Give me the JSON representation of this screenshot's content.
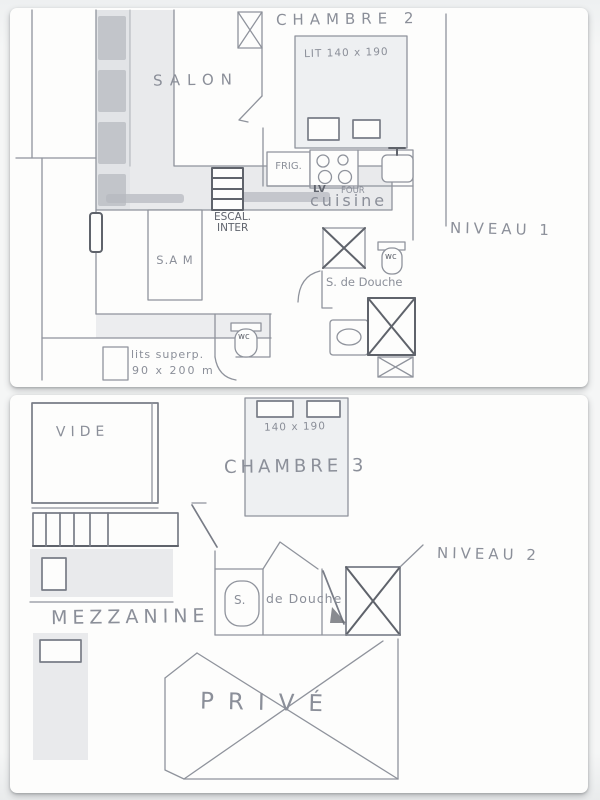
{
  "colors": {
    "background": "#f2f3f4",
    "paper": "#fdfdfc",
    "pencil": "#8f939c",
    "pencil_dark": "#5f636b",
    "wall_shade": "#e9eaec",
    "wall_block": "#b6b9bf"
  },
  "niveau1": {
    "title": "NIVEAU  1",
    "salon": "SALON",
    "chambre2_title": "CHAMBRE 2",
    "chambre2_bed": "LIT 140 x 190",
    "frig": "FRIG.",
    "lv": "LV",
    "four": "FOUR",
    "cuisine": "cuisine",
    "escal_line1": "ESCAL.",
    "escal_line2": "INTER",
    "sam": "S.A M",
    "douche_label": "S. de Douche",
    "wc_bath": "wc",
    "wc_small": "wc",
    "lits_line1": "lits superp.",
    "lits_line2": "90 x 200 m"
  },
  "niveau2": {
    "title": "NIVEAU  2",
    "vide": "VIDE",
    "chambre3_bed": "140 x 190",
    "chambre3_title": "CHAMBRE 3",
    "mezzanine": "MEZZANINE",
    "douche_s": "S.",
    "douche_rest": "de Douche",
    "prive": "PRIVÉ"
  }
}
